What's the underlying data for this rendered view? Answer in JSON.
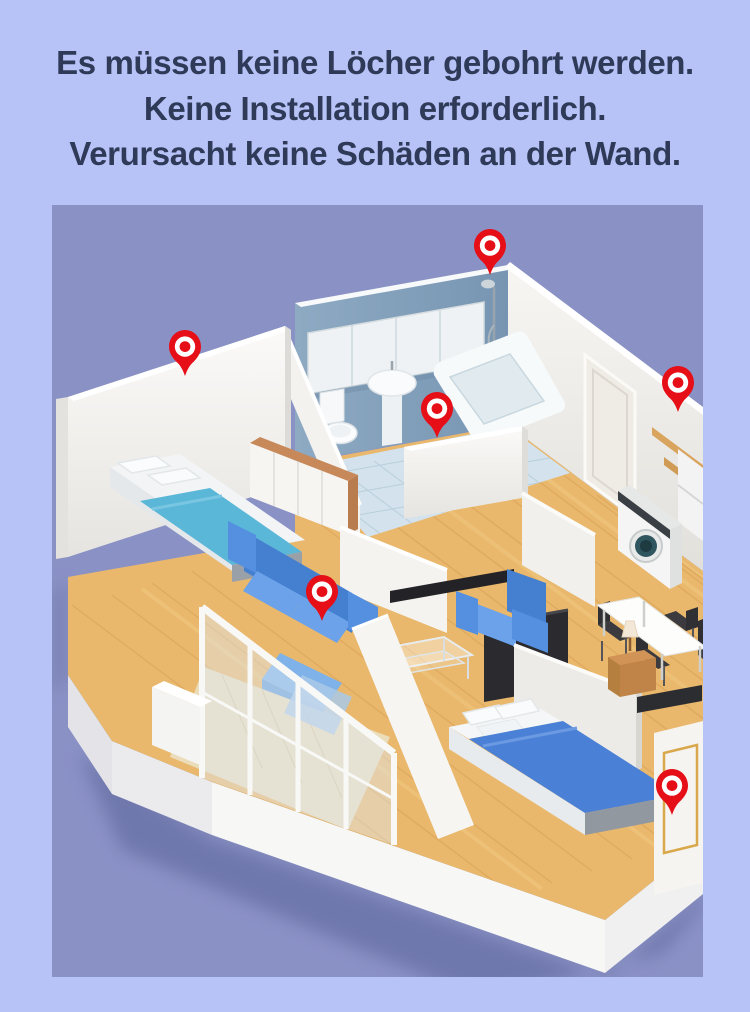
{
  "heading": {
    "line1": "Es müssen keine Löcher gebohrt werden.",
    "line2": "Keine Installation erforderlich.",
    "line3": "Verursacht keine Schäden an der Wand."
  },
  "figure": {
    "type": "isometric-apartment-floorplan-render",
    "pins": [
      {
        "id": "pin-bathroom-back-wall-corner",
        "transform": "translate(420,23)"
      },
      {
        "id": "pin-bedroom-outer-wall",
        "transform": "translate(115,124)"
      },
      {
        "id": "pin-bathroom-half-wall",
        "transform": "translate(367,186)"
      },
      {
        "id": "pin-kitchen-shelf-wall",
        "transform": "translate(608,160)"
      },
      {
        "id": "pin-living-room-sofa",
        "transform": "translate(252,369)"
      },
      {
        "id": "pin-bedroom2-floor",
        "transform": "translate(602,563)"
      }
    ],
    "colors": {
      "page_background": "#b7c2f7",
      "figure_background": "#8a91c5",
      "pin_red": "#e60e17",
      "wall_white": "#f5f4f1",
      "bathroom_wall_blue": "#84a0bb",
      "floor_wood": "#e9b86c",
      "bathroom_tile": "#d3e2ec",
      "sofa_blue": "#4a84d8",
      "bed_teal": "#5bb7d8",
      "bed_blue": "#4a80d6",
      "heading_text": "#2e3a57"
    }
  }
}
